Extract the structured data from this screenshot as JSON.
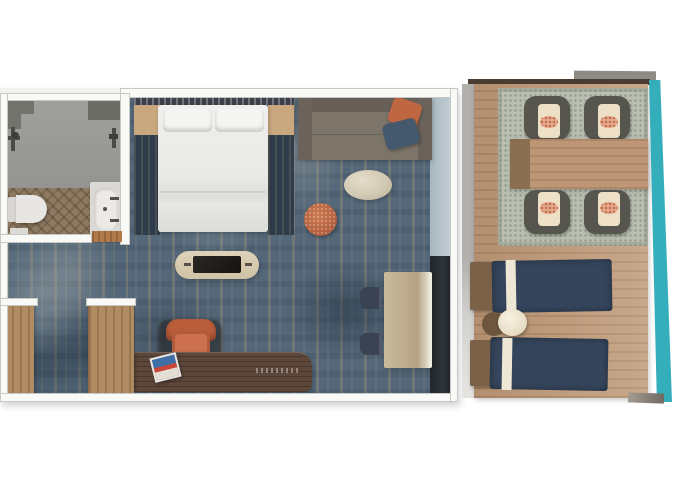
{
  "scene": {
    "type": "floor-plan",
    "description": "Top-down rendering of a stateroom suite with private balcony",
    "background": "#ffffff"
  },
  "palette": {
    "wall": "#f9f9f7",
    "wall_outline": "#c7c7c3",
    "carpet_blue": "#54687a",
    "carpet_tan_accent": "#b69e76",
    "bathroom_tile": "#9a9a96",
    "bathroom_wood": "#8d7a61",
    "closet_wood": "#b18c63",
    "balcony_deck": "#c09a77",
    "desk_wood": "#5c473a",
    "bed_linen": "#e9e9e7",
    "sofa_taupe": "#776f66",
    "accent_orange": "#bf6742",
    "accent_navy": "#44586e",
    "lounger_navy": "#35455c",
    "outdoor_rug_sage": "#bac0b1",
    "cushion_cream": "#eee0c6",
    "balcony_edge_teal": "#35aebc"
  },
  "stateroom": {
    "bathroom": {
      "items": [
        "shower-area",
        "shower-fixture",
        "toilet",
        "vanity-sink",
        "bath-mat",
        "door-threshold"
      ]
    },
    "bedroom": {
      "items": [
        "headboard",
        "double-bed",
        "pillows",
        "nightstand-left",
        "nightstand-right",
        "bedside-runner-left",
        "bedside-runner-right",
        "sofa",
        "orange-throw-pillow",
        "navy-throw-pillow",
        "oval-coffee-table",
        "orange-ottoman",
        "tv-console",
        "tv-screen"
      ]
    },
    "work_dining": {
      "items": [
        "desk",
        "desk-chair",
        "magazine",
        "window-dining-table",
        "dining-chair-1",
        "dining-chair-2"
      ]
    },
    "entry": {
      "items": [
        "wardrobe-left",
        "wardrobe-right",
        "entry-corridor"
      ]
    },
    "glazing": {
      "items": [
        "window-strip",
        "glass-door"
      ]
    }
  },
  "balcony": {
    "items": [
      "outdoor-rug",
      "outdoor-dining-table",
      "outdoor-chair-1",
      "outdoor-chair-2",
      "outdoor-chair-3",
      "outdoor-chair-4",
      "sun-lounger-1",
      "sun-lounger-2",
      "round-side-table"
    ],
    "edge_color": "#35aebc"
  },
  "labels": {
    "stateroom": "Stateroom",
    "bathroom": "Bathroom",
    "bed": "Double bed",
    "sofa": "Sofa",
    "coffee_table": "Oval coffee table",
    "ottoman": "Ottoman",
    "tv": "TV console",
    "desk": "Desk",
    "dining_table": "Dining table",
    "wardrobe": "Wardrobe",
    "balcony": "Balcony",
    "lounger": "Sun lounger",
    "outdoor_table": "Outdoor dining table"
  }
}
